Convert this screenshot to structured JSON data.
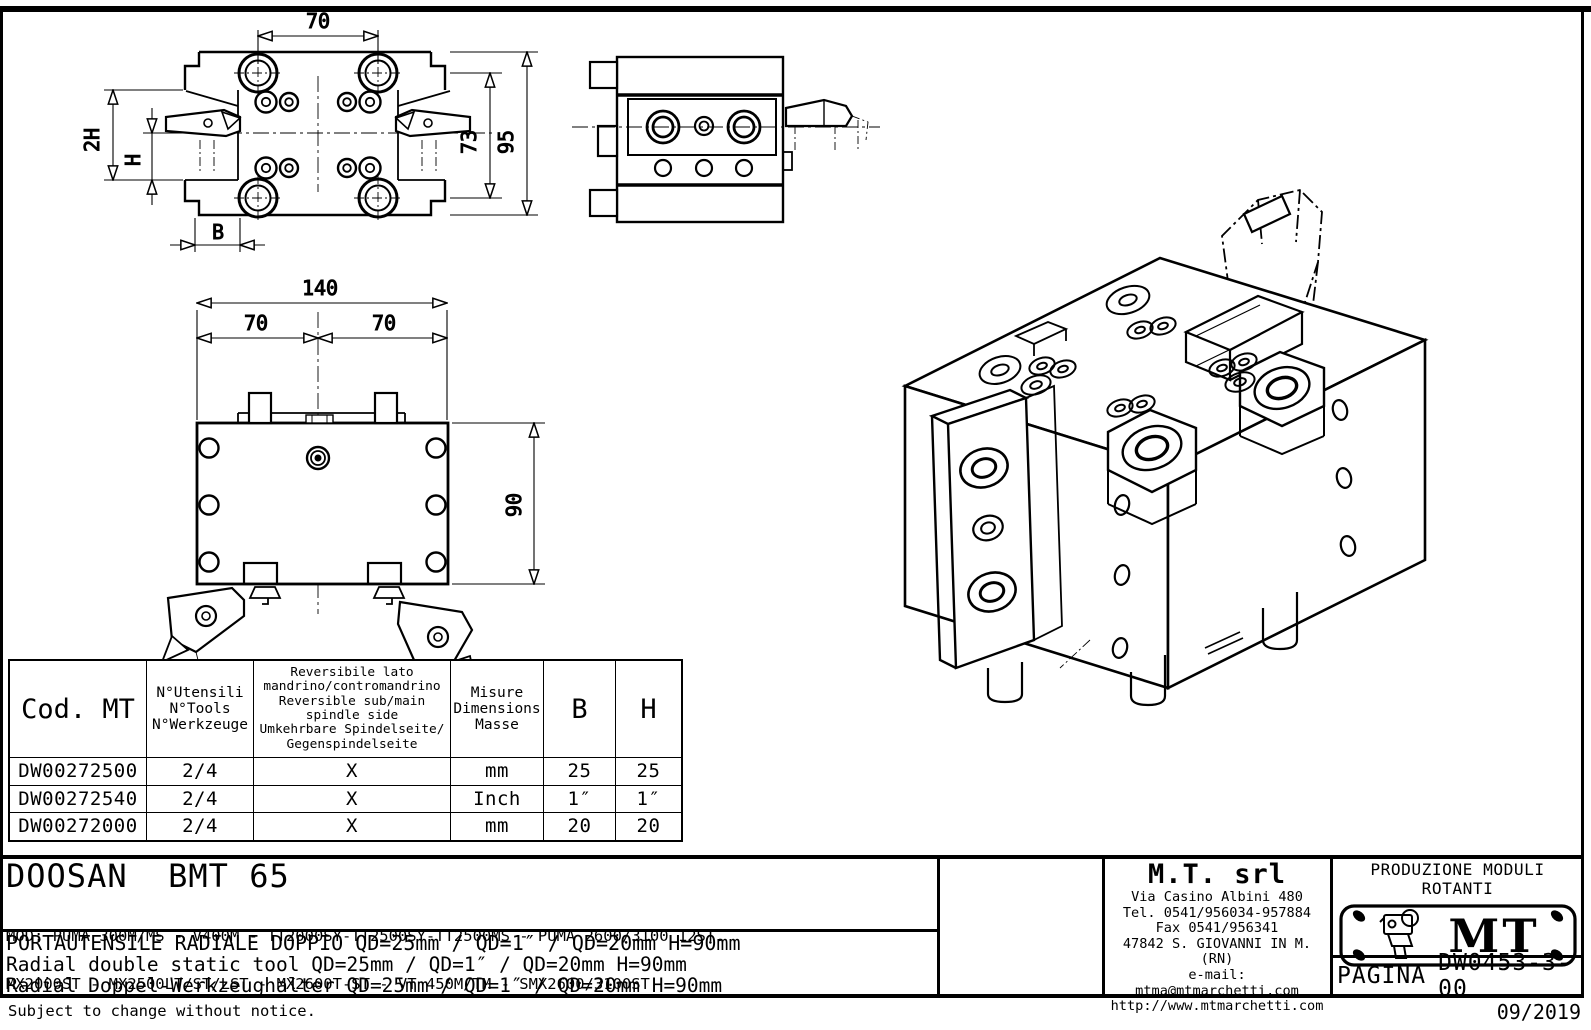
{
  "sheet": {
    "footer_note": "Subject to change without notice.",
    "footer_date": "09/2019",
    "line_color": "#000000",
    "paper_color": "#ffffff"
  },
  "drawing": {
    "top_view": {
      "dim_width": "70",
      "dim_bolt_spacing": "73",
      "dim_height": "95",
      "dim_2h": "2H",
      "dim_h": "H",
      "dim_b": "B"
    },
    "front_view": {
      "dim_total": "140",
      "dim_left": "70",
      "dim_right": "70",
      "dim_height": "90"
    }
  },
  "table": {
    "header": {
      "cod": "Cod. MT",
      "tools": "N°Utensili\nN°Tools\nN°Werkzeuge",
      "reversible": "Reversibile lato\nmandrino/contromandrino\nReversible sub/main\nspindle side\nUmkehrbare Spindelseite/\nGegenspindelseite",
      "measure": "Misure\nDimensions\nMasse",
      "b": "B",
      "h": "H"
    },
    "rows": [
      {
        "cod": "DW00272500",
        "tools": "2/4",
        "reversible": "X",
        "measure": "mm",
        "b": "25",
        "h": "25"
      },
      {
        "cod": "DW00272540",
        "tools": "2/4",
        "reversible": "X",
        "measure": "Inch",
        "b": "1″",
        "h": "1″"
      },
      {
        "cod": "DW00272000",
        "tools": "2/4",
        "reversible": "X",
        "measure": "mm",
        "b": "20",
        "h": "20"
      }
    ]
  },
  "title_block": {
    "model": "DOOSAN  BMT 65",
    "mod_line1": "MOD: PUMA 300M/MS - V400M - TT2000SY-TT2500SY-TT2500MS - PUMA 2600/3100 12ST.",
    "mod_line2": "MX2000ST - MX2500LT/ST/LST - MX2600T-ST - VT 450M/TM - SMX2600/3100ST",
    "desc_it": "PORTAUTENSILE RADIALE DOPPIO QD=25mm / QD=1″ / QD=20mm H=90mm",
    "desc_en": "Radial double static tool QD=25mm / QD=1″ / QD=20mm H=90mm",
    "desc_de": "Radial Doppel-Werkzeughalter QD=25mm / QD=1″ / QD=20mm H=90mm",
    "company": {
      "name": "M.T. srl",
      "address": "Via Casino Albini 480",
      "phone": "Tel. 0541/956034-957884",
      "fax": "Fax 0541/956341",
      "city": "47842 S. GIOVANNI IN M. (RN)",
      "email": "e-mail: mtma@mtmarchetti.com",
      "website": "http://www.mtmarchetti.com"
    },
    "claim": "PRODUZIONE MODULI ROTANTI",
    "logo_text": "MT",
    "page_label": "PAGINA",
    "page_code": "DW0453-3-00"
  }
}
